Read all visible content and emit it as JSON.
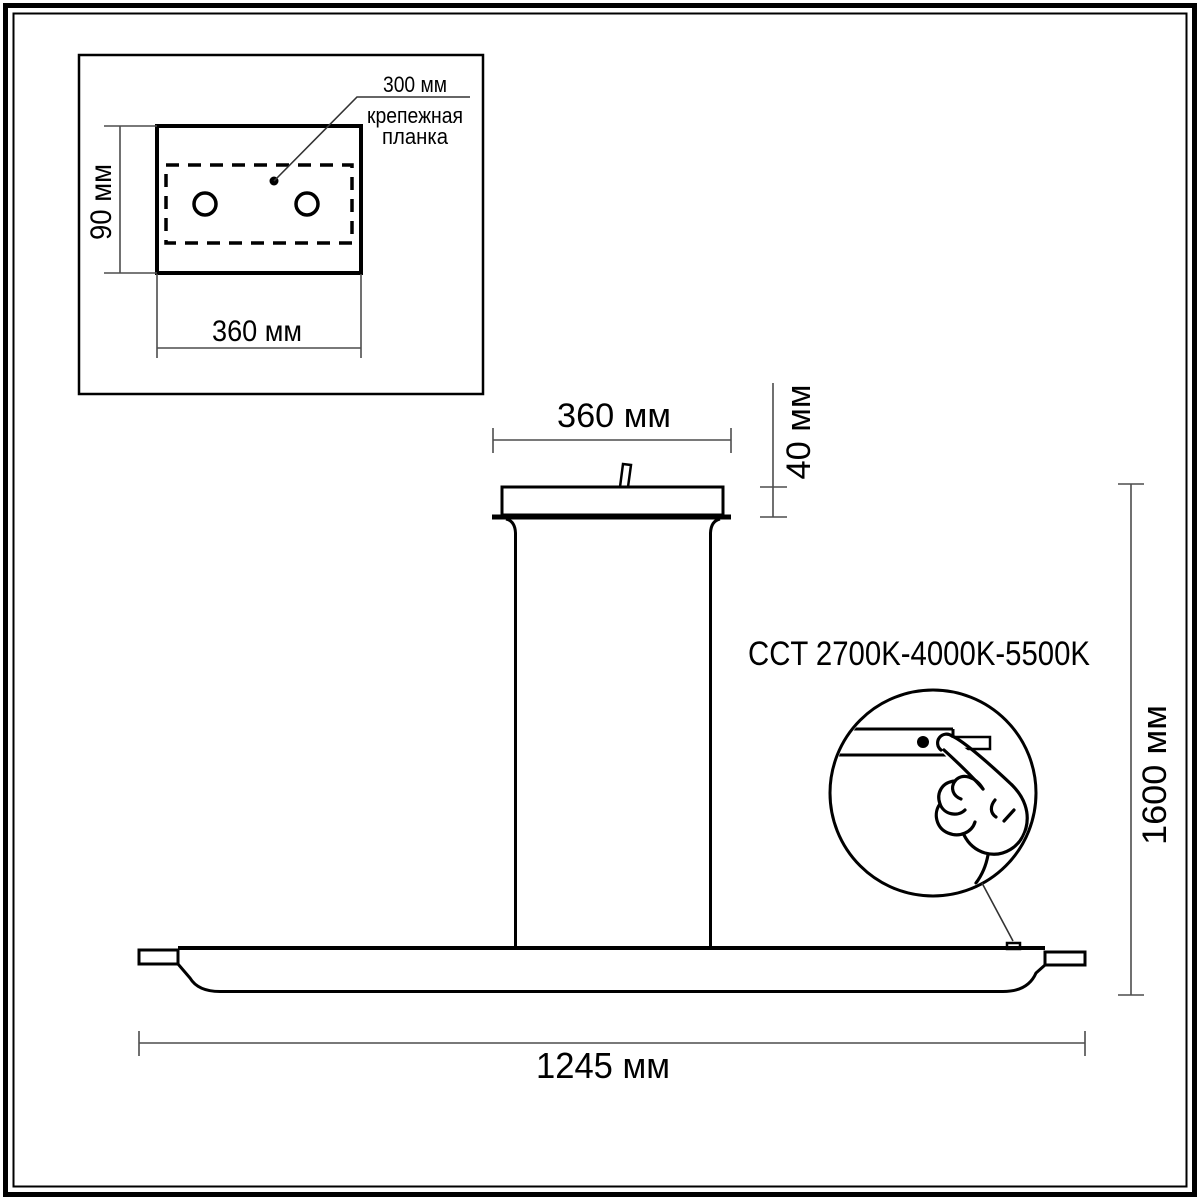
{
  "drawing": {
    "title": "pendant-light-dimension-drawing",
    "inset": {
      "bar_offset_label": "300 мм",
      "bar_name_line1": "крепежная",
      "bar_name_line2": "планка",
      "plate_height_dim": "90 мм",
      "plate_width_dim": "360 мм"
    },
    "main": {
      "canopy_width_dim": "360 мм",
      "canopy_height_dim": "40 мм",
      "overall_height_dim": "1600 мм",
      "fixture_length_dim": "1245 мм",
      "cct_label": "CCT 2700K-4000K-5500K"
    },
    "colors": {
      "object_line": "#000000",
      "dimension_line": "#4d4d4d",
      "background": "#ffffff"
    }
  }
}
